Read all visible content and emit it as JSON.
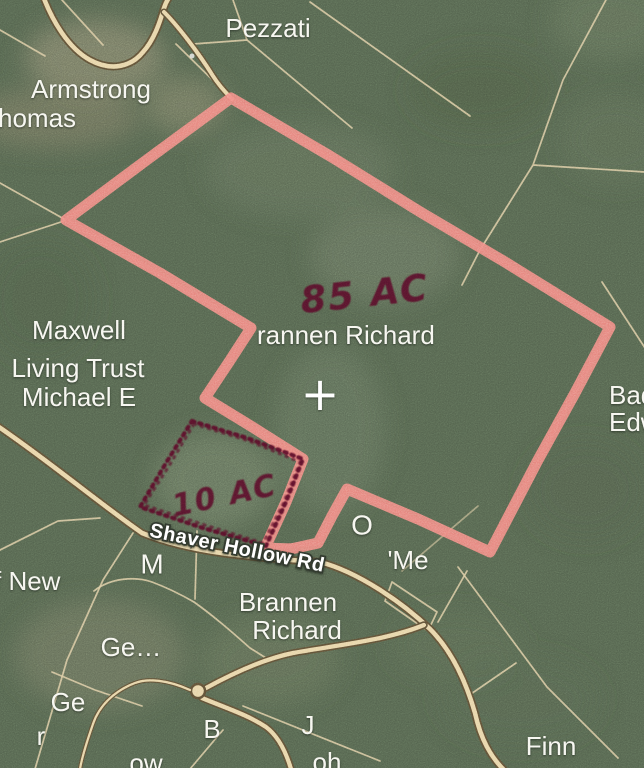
{
  "map": {
    "labels": {
      "pezzati": "Pezzati",
      "armstrong": "Armstrong",
      "thomas_partial": "homas",
      "maxwell_line1": "Maxwell",
      "maxwell_line2": "Living Trust",
      "maxwell_line3": "Michael E",
      "brannen_center_partial": "rannen Richard",
      "bad_partial": "Bad",
      "edw_partial": "Edw",
      "initial_m": "M",
      "initial_o": "O",
      "me_partial": "'Me",
      "new_partial": "f New",
      "brannen_bottom_line1": "Brannen",
      "brannen_bottom_line2": "Richard",
      "ge_truncated": "Ge…",
      "initial_ge": "Ge",
      "initial_r": "r",
      "initial_b": "B",
      "initial_j": "J",
      "ow_partial": "ow",
      "oh_partial": "oh",
      "finn": "Finn"
    },
    "road_label": "Shaver Hollow Rd",
    "annotations": {
      "acreage_large": "85 AC",
      "acreage_small": "10 AC"
    },
    "icons": {
      "crosshair": "+"
    },
    "colors": {
      "background_green": "#53624d",
      "boundary_pink": "#f0857e",
      "marker_maroon": "#551127",
      "parcel_line": "#dbc99d",
      "road_fill": "#e6d3a4",
      "road_casing": "#5c4e35",
      "label_white": "#f6f6ef"
    }
  }
}
